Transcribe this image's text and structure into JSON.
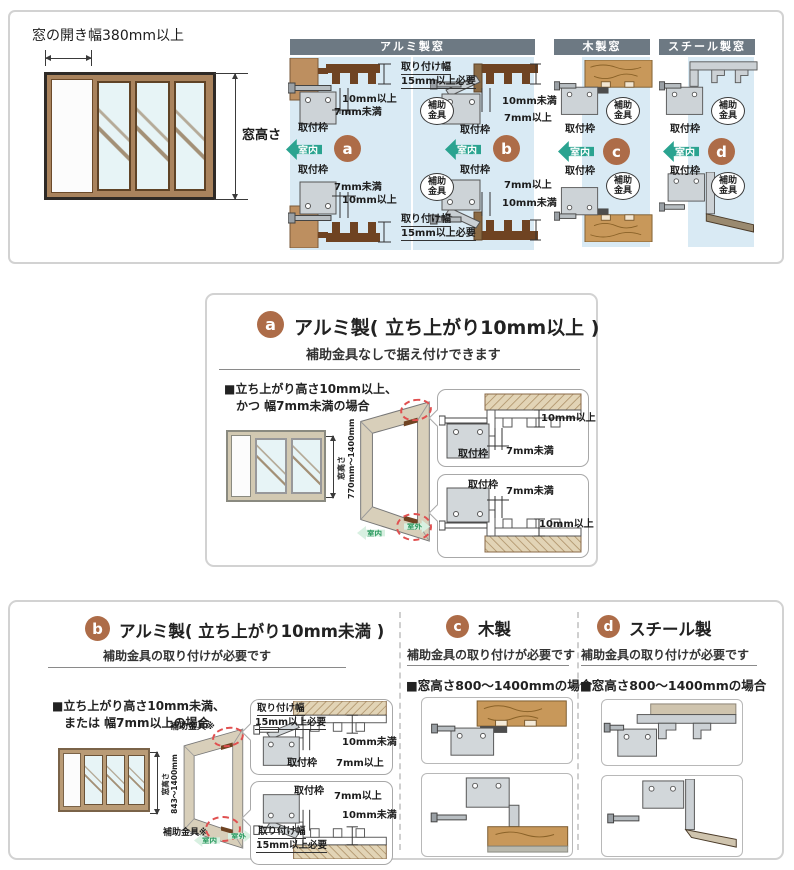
{
  "colors": {
    "accent_brown": "#ad6c48",
    "teal_arrow": "#2aa390",
    "header_gray": "#6d7983",
    "panel_blue": "#d9eaf4",
    "red_dashed": "#e05050",
    "green_arrow": "#27985c"
  },
  "p1": {
    "opening_width": "窓の開き幅380mm以上",
    "window_height": "窓高さ",
    "hdr_alu": "アルミ製窓",
    "hdr_wood": "木製窓",
    "hdr_steel": "スチール製窓",
    "room_in": "室内",
    "frame_label": "取付枠",
    "aux_label": "補助金具",
    "a": {
      "badge": "a",
      "top_dim1": "10mm以上",
      "top_dim2": "7mm未満",
      "bot_dim1": "7mm未満",
      "bot_dim2": "10mm以上"
    },
    "b": {
      "badge": "b",
      "width1": "取り付け幅",
      "width2": "15mm以上必要",
      "top_dim1": "10mm未満",
      "top_dim2": "7mm以上",
      "bot_dim1": "7mm以上",
      "bot_dim2": "10mm未満"
    },
    "c": {
      "badge": "c"
    },
    "d": {
      "badge": "d"
    }
  },
  "p2": {
    "badge": "a",
    "title": "アルミ製( 立ち上がり10mm以上 )",
    "subtitle": "補助金具なしで据え付けできます",
    "cond1": "■立ち上がり高さ10mm以上、",
    "cond2": "かつ 幅7mm未満の場合",
    "dim_label": "窓高さ",
    "dim_range": "770mm〜1400mm",
    "frame_label": "取付枠",
    "top_dim1": "10mm以上",
    "top_dim2": "7mm未満",
    "bot_dim1": "7mm未満",
    "bot_dim2": "10mm以上",
    "room_in": "室内",
    "room_out": "室外"
  },
  "p3": {
    "b": {
      "badge": "b",
      "title": "アルミ製( 立ち上がり10mm未満 )",
      "subtitle": "補助金具の取り付けが必要です",
      "cond1": "■立ち上がり高さ10mm未満、",
      "cond2": "または 幅7mm以上の場合",
      "dim_label": "窓高さ",
      "dim_range": "843〜1400mm",
      "aux_label": "補助金具※",
      "width1": "取り付け幅",
      "width2": "15mm以上必要",
      "top_dim1": "10mm未満",
      "top_dim2": "7mm以上",
      "bot_dim1": "7mm以上",
      "bot_dim2": "10mm未満",
      "frame_label": "取付枠",
      "room_in": "室内",
      "room_out": "室外"
    },
    "c": {
      "badge": "c",
      "title": "木製",
      "subtitle": "補助金具の取り付けが必要です",
      "case": "■窓高さ800〜1400mmの場合"
    },
    "d": {
      "badge": "d",
      "title": "スチール製",
      "subtitle": "補助金具の取り付けが必要です",
      "case": "■窓高さ800〜1400mmの場合"
    }
  }
}
